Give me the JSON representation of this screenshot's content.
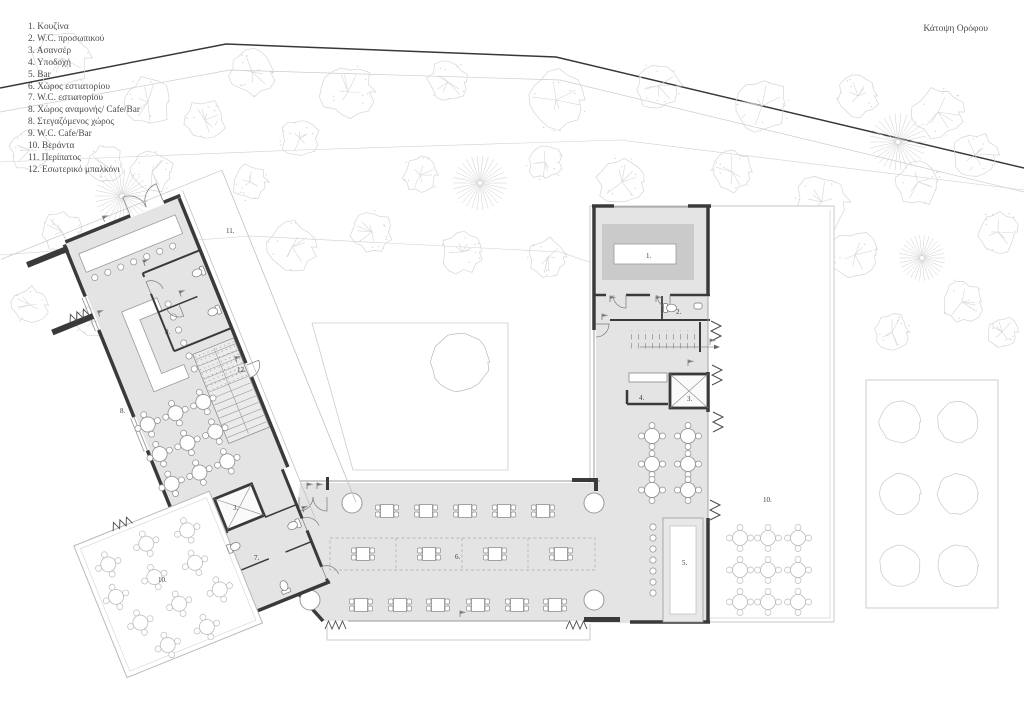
{
  "title": "Κάτοψη Ορόφου",
  "legend": {
    "items": [
      "1. Κουζίνα",
      "2. W.C. προσωπικού",
      "3. Ασανσέρ",
      "4. Υποδοχή",
      "5. Bar",
      "6. Χώρος εστιατορίου",
      "7. W.C. εστιατορίου",
      "8. Χώρος αναμονής/ Cafe/Bar",
      "8. Στεγαζόμενος χώρος",
      "9. W.C. Cafe/Bar",
      "10. Βεράντα",
      "11. Περίπατος",
      "12. Εσωτερικό μπαλκόνι"
    ]
  },
  "plan": {
    "room_labels": [
      {
        "room": "kitchen",
        "text": "1."
      },
      {
        "room": "wc-staff",
        "text": "2."
      },
      {
        "room": "elevator-right",
        "text": "3."
      },
      {
        "room": "reception",
        "text": "4."
      },
      {
        "room": "bar",
        "text": "5."
      },
      {
        "room": "dining-hall",
        "text": "6."
      },
      {
        "room": "wc-restaurant",
        "text": "7."
      },
      {
        "room": "cafe-bar",
        "text": "8."
      },
      {
        "room": "wc-cafebar",
        "text": "9."
      },
      {
        "room": "terrace-left",
        "text": "10."
      },
      {
        "room": "terrace-right",
        "text": "10."
      },
      {
        "room": "walkway",
        "text": "11."
      },
      {
        "room": "inner-balcony",
        "text": "12."
      },
      {
        "room": "elevator-left",
        "text": "3."
      }
    ]
  },
  "palette": {
    "floor": "#e4e4e4",
    "wall": "#3a3a3a",
    "counter": "#cacaca",
    "thin": "#9b9b9b",
    "tree": "#d6d6d6",
    "site_boundary": "#383838"
  }
}
